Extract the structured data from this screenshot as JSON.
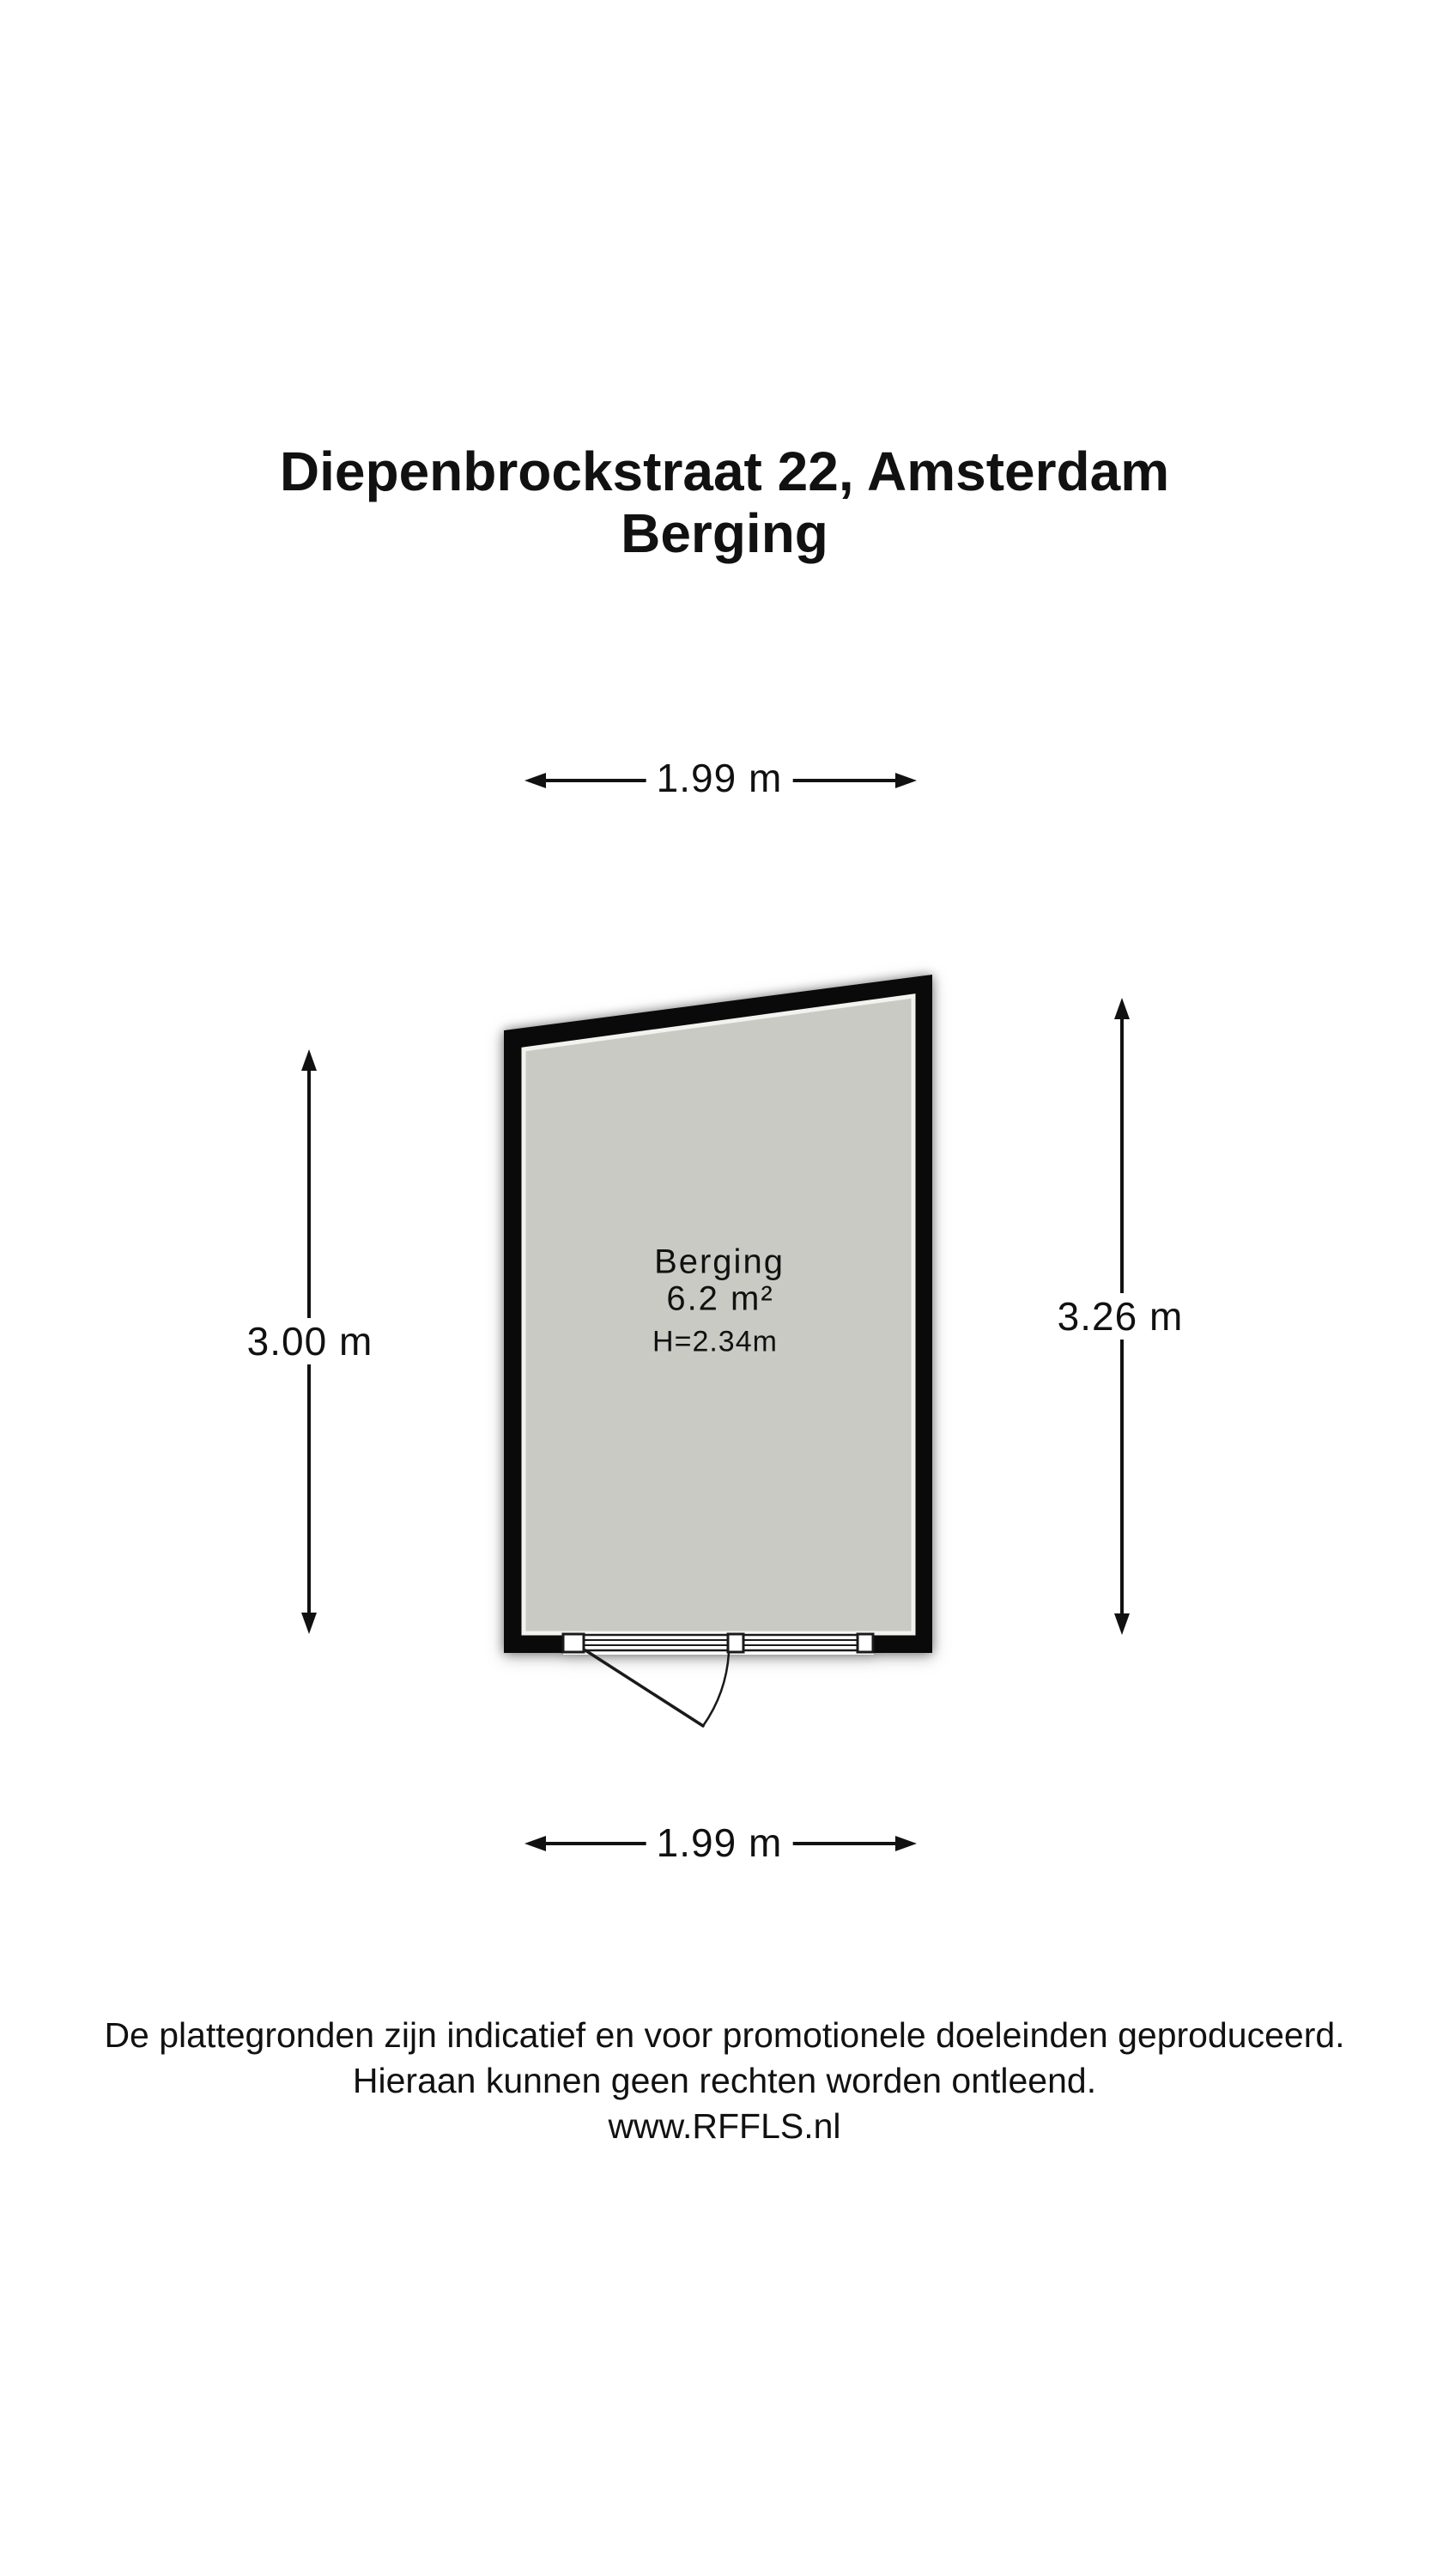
{
  "title": {
    "line1": "Diepenbrockstraat 22, Amsterdam",
    "line2": "Berging"
  },
  "room": {
    "name": "Berging",
    "area": "6.2 m²",
    "ceiling_height": "H=2.34m"
  },
  "dimensions": {
    "top_width": "1.99 m",
    "bottom_width": "1.99 m",
    "left_height": "3.00 m",
    "right_height": "3.26 m"
  },
  "footer": {
    "line1": "De plattegronden zijn indicatief en voor promotionele doeleinden geproduceerd.",
    "line2": "Hieraan kunnen geen rechten worden ontleend.",
    "line3": "www.RFFLS.nl"
  },
  "colors": {
    "wall": "#0a0a0a",
    "floor": "#c9cac3",
    "floor_edge": "#f2f2ee",
    "line": "#1a1a1a",
    "background": "#ffffff"
  }
}
